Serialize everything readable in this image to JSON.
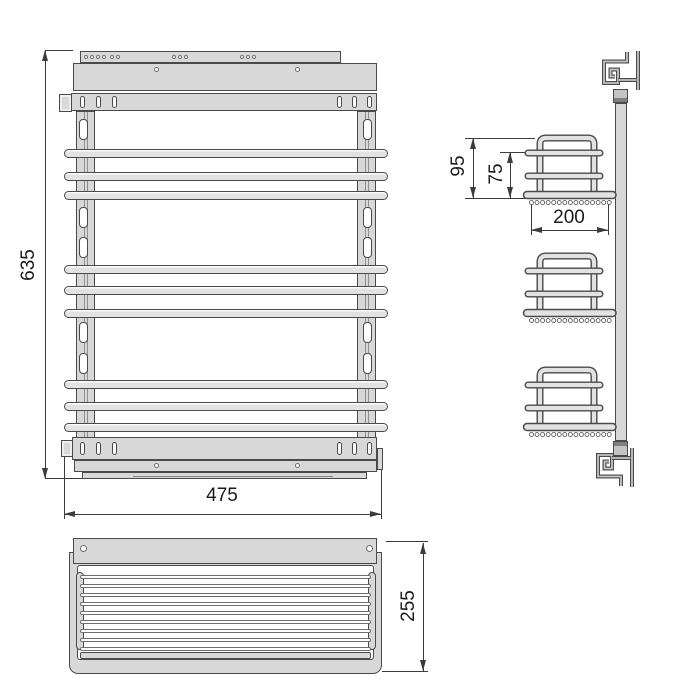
{
  "drawing": {
    "type": "technical-drawing",
    "subject": "pull-out-wire-basket-spice-rack",
    "colors": {
      "fill": "#d8d8d8",
      "fill_light": "#e2e2e2",
      "outline": "#4a4a4a",
      "groove": "#8f8f8f",
      "cap": "#c4c4c4",
      "cap_dark": "#7f7f7f",
      "dim": "#3c3c3c",
      "text": "#1a1a1a",
      "white": "#ffffff"
    },
    "front_view": {
      "dim_height": "635",
      "dim_width": "475",
      "bar_tops": [
        149,
        172,
        191,
        265,
        286,
        309,
        380,
        402,
        423
      ],
      "post_slot_tops": [
        119,
        207,
        237,
        322,
        353
      ],
      "top_strip_holes": [
        84,
        90,
        96,
        102,
        110,
        116,
        172,
        178,
        184,
        240,
        246,
        252
      ],
      "band_holes": [
        154,
        295
      ],
      "rail_slots_left": [
        80,
        96,
        112
      ],
      "rail_slots_right": [
        337,
        352,
        367
      ]
    },
    "side_view": {
      "dim_basket_outer_height": "95",
      "dim_basket_inner_height": "75",
      "dim_basket_depth": "200",
      "basket_base_y": [
        195.5,
        313.5,
        427.5
      ],
      "basket_circle_count": 15
    },
    "plan_view": {
      "dim_depth": "255",
      "wire_tops": [
        575,
        584,
        593,
        602,
        611,
        620,
        629,
        638,
        647
      ]
    }
  }
}
